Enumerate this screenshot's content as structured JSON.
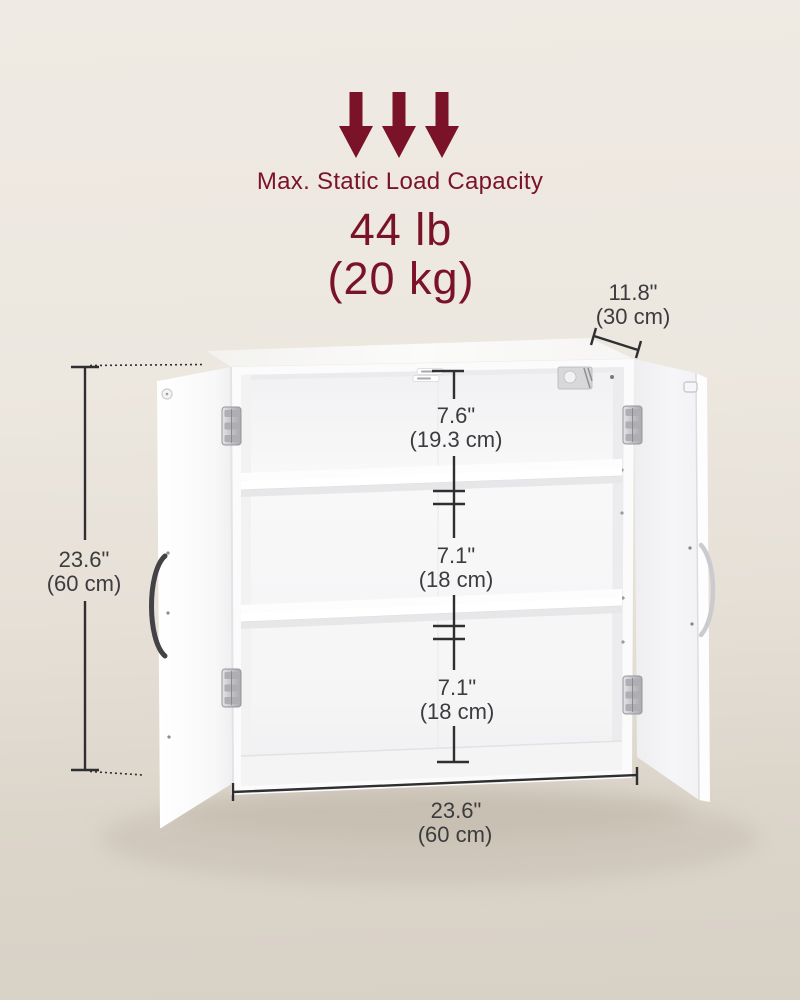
{
  "load_capacity": {
    "title": "Max. Static Load Capacity",
    "pounds": "44 lb",
    "kilograms": "(20 kg)",
    "arrow_icon": "down-arrow",
    "accent_color": "#7a1228"
  },
  "dimensions": {
    "depth": {
      "inches": "11.8\"",
      "centimeters": "(30 cm)"
    },
    "height": {
      "inches": "23.6\"",
      "centimeters": "(60 cm)"
    },
    "width": {
      "inches": "23.6\"",
      "centimeters": "(60 cm)"
    },
    "compartments": [
      {
        "inches": "7.6\"",
        "centimeters": "(19.3 cm)"
      },
      {
        "inches": "7.1\"",
        "centimeters": "(18 cm)"
      },
      {
        "inches": "7.1\"",
        "centimeters": "(18 cm)"
      }
    ],
    "annotation_color": "#3c3c3e"
  },
  "scene": {
    "background_top": "#efeae3",
    "background_bottom": "#d8d1c6",
    "cabinet_color": "#fbfbfc"
  }
}
